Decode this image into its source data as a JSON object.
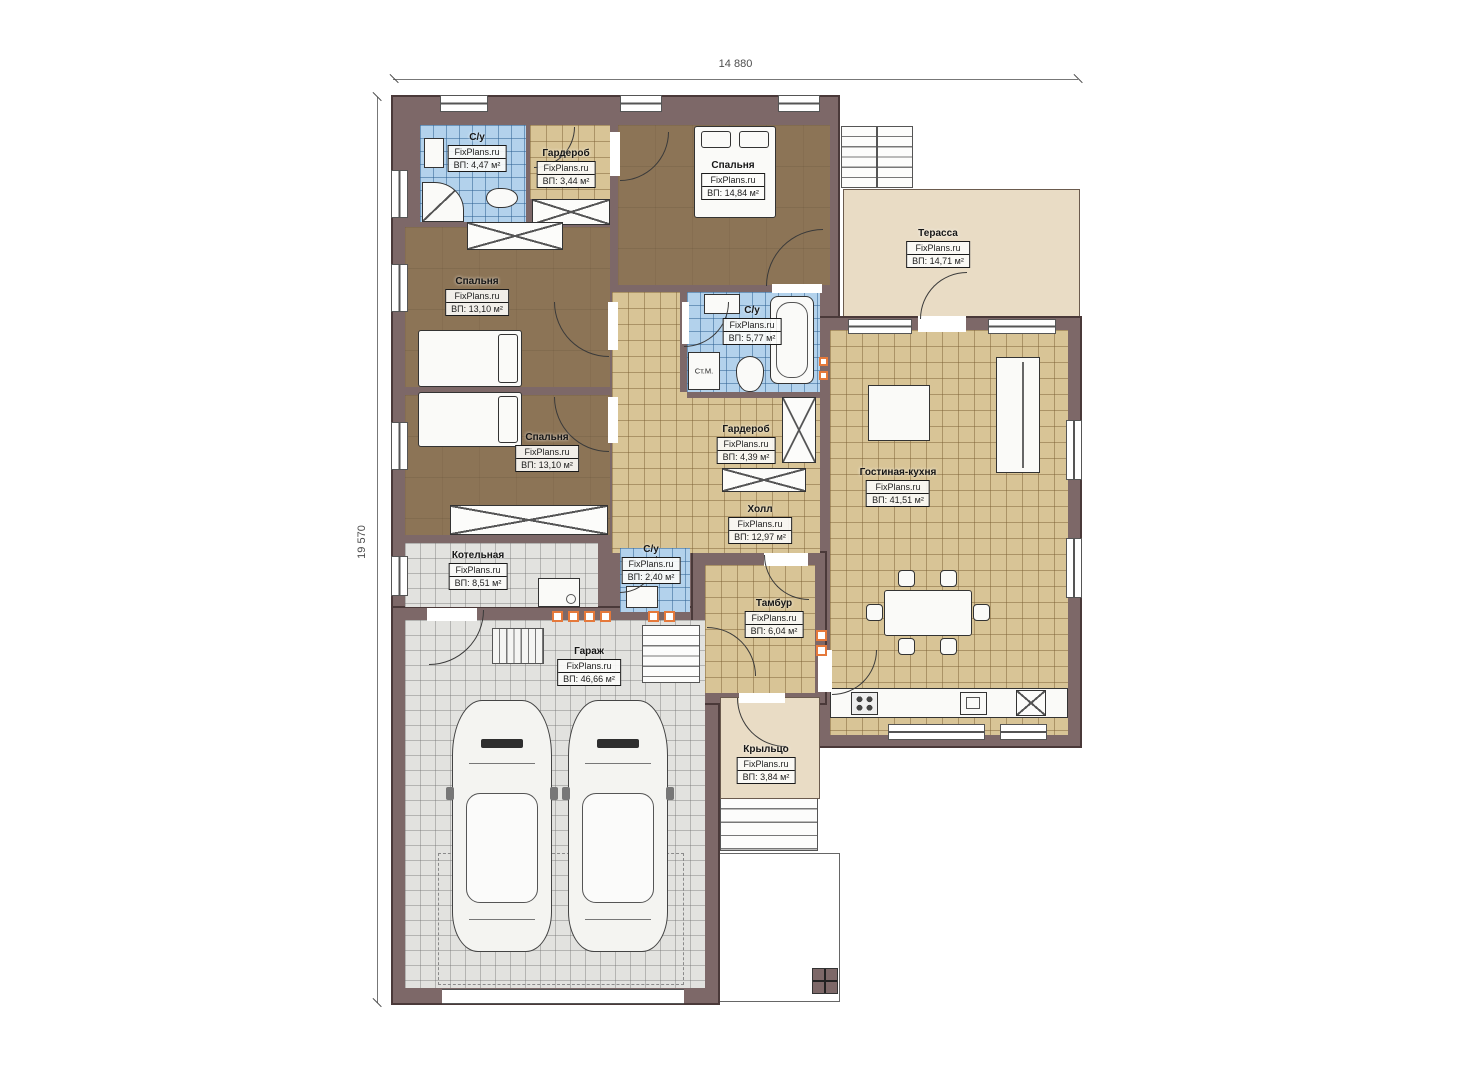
{
  "watermark": "FixPlans.ru",
  "dimensions": {
    "width_label": "14 880",
    "height_label": "19 570"
  },
  "rooms": [
    {
      "name": "С/у",
      "area": "ВП: 4,47 м²"
    },
    {
      "name": "Гардероб",
      "area": "ВП: 3,44 м²"
    },
    {
      "name": "Спальня",
      "area": "ВП: 14,84 м²"
    },
    {
      "name": "Терасса",
      "area": "ВП: 14,71 м²"
    },
    {
      "name": "Спальня",
      "area": "ВП: 13,10 м²"
    },
    {
      "name": "С/у",
      "area": "ВП: 5,77 м²"
    },
    {
      "name": "Гардероб",
      "area": "ВП: 4,39 м²"
    },
    {
      "name": "Спальня",
      "area": "ВП: 13,10 м²"
    },
    {
      "name": "Гостиная-кухня",
      "area": "ВП: 41,51 м²"
    },
    {
      "name": "Холл",
      "area": "ВП: 12,97 м²"
    },
    {
      "name": "Котельная",
      "area": "ВП: 8,51 м²"
    },
    {
      "name": "С/у",
      "area": "ВП: 2,40 м²"
    },
    {
      "name": "Тамбур",
      "area": "ВП: 6,04 м²"
    },
    {
      "name": "Гараж",
      "area": "ВП: 46,66 м²"
    },
    {
      "name": "Крыльцо",
      "area": "ВП: 3,84 м²"
    }
  ],
  "appliances": {
    "washing_machine": "Ст.М."
  },
  "colors": {
    "wall": "#7d6868",
    "tile_blue": "#b3d2ec",
    "tile_tan": "#d8c496",
    "tile_gray": "#e2e2df",
    "floor_brown": "#8c7456",
    "terrace": "#e9dcc5",
    "vent_orange": "#e5793b"
  }
}
